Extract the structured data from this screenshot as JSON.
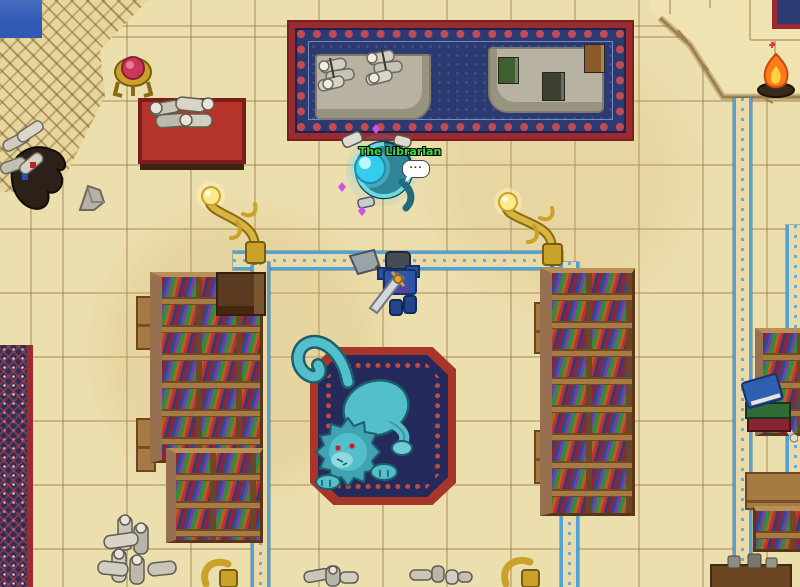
{
  "scene": {
    "name": "library-room",
    "npc": {
      "name": "The Librarian",
      "name_color": "#3ce03c",
      "speech_bubble": "..."
    },
    "palette": {
      "floor_sand": "#ecdfae",
      "tile_line": "#9a7a44",
      "carpet_red": "#9b2b30",
      "carpet_navy": "#2c3a72",
      "inlay_blue": "#4fa3d6",
      "wood": "#a57a43",
      "wood_dark": "#5a3516",
      "gold": "#caa22a",
      "statue_teal": "#53bfca",
      "npc_body": "#2e8598",
      "orb_cyan": "#35cdeb",
      "player_armor": "#2c55a8",
      "pool_blue": "#2e59b5",
      "stone_grey": "#b7b2a1",
      "fire_orange": "#ff7a1a"
    },
    "entities": {
      "pool": "water-pool",
      "ramp": "stair-ramp",
      "platform": "raised-platform",
      "top_carpet": "ornate-blue-carpet",
      "counters": "stone-counters",
      "scrolls": "scroll-piles",
      "books": "books",
      "gem_stand": "gem-pedestal",
      "scroll_table": "red-scroll-table",
      "lamps": "golden-serpent-lamp",
      "statue": "blue-beast-statue",
      "center_rug": "ornate-blue-rug",
      "player": "player-character",
      "bookshelves": "bookshelves",
      "campfire": "campfire",
      "book_stack": "book-stack"
    }
  }
}
